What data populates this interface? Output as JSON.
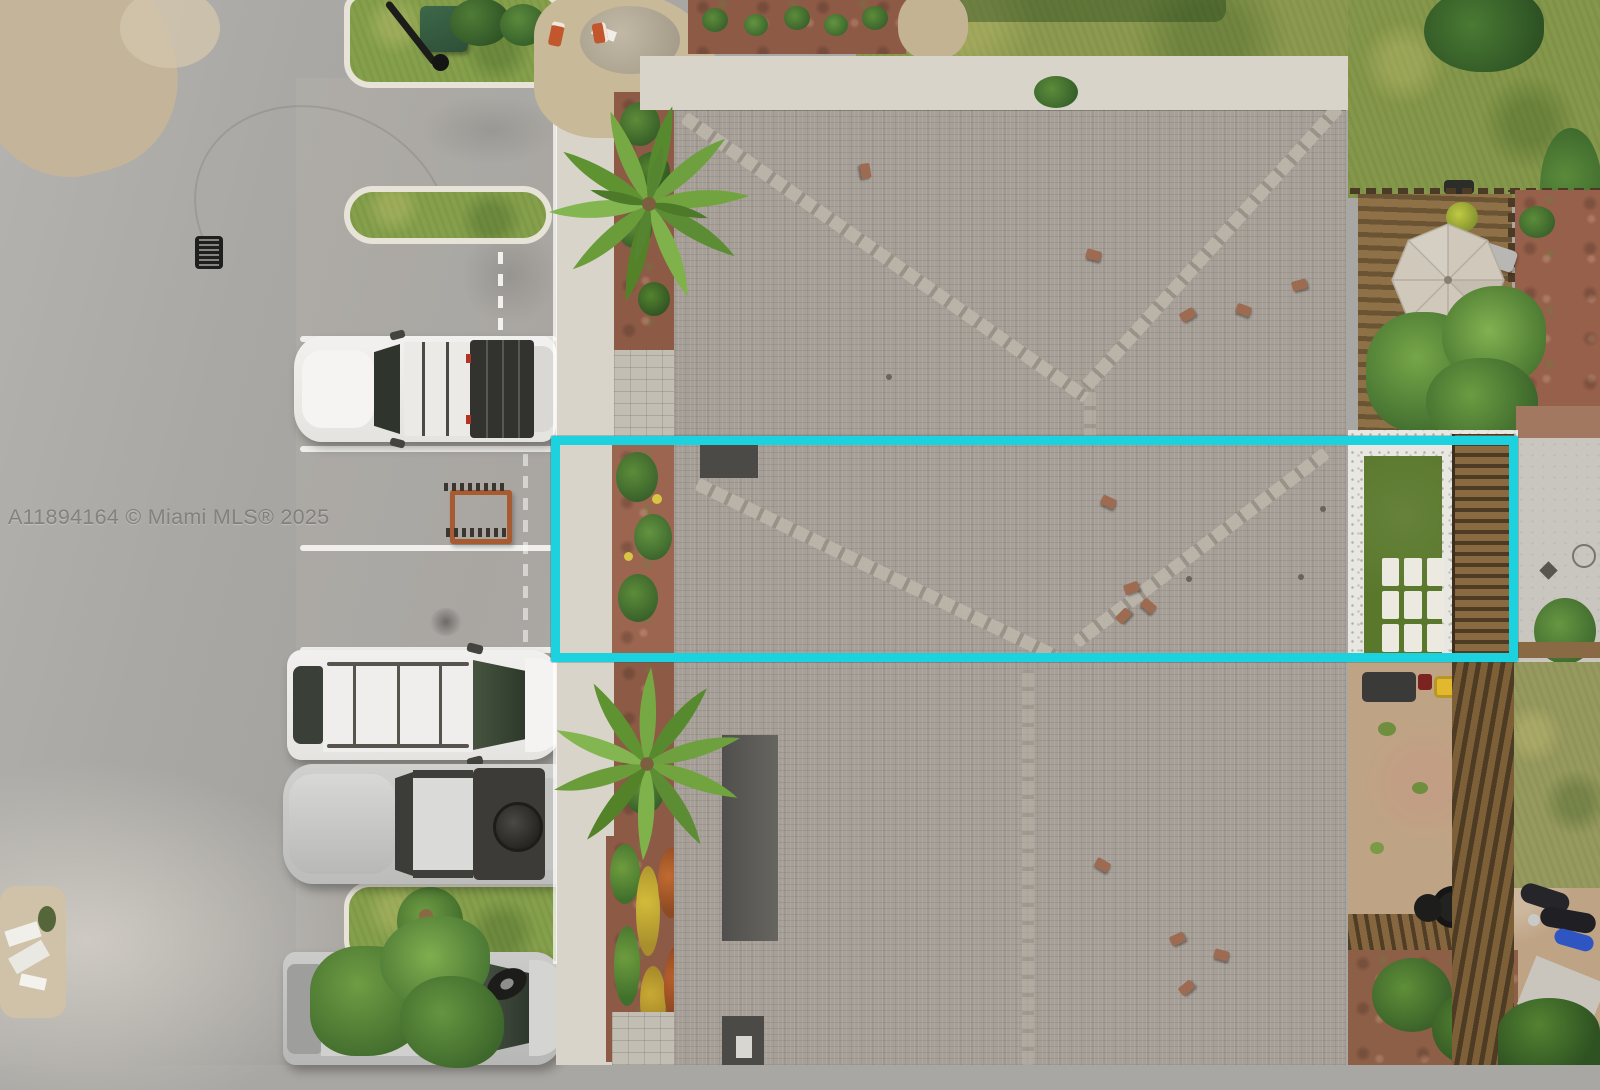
{
  "watermark": {
    "text": "A11894164 © Miami MLS® 2025"
  },
  "colors": {
    "highlight": "#1BD2DE",
    "asphalt": "#A9A7A3",
    "concrete": "#D9D4CA",
    "roof": "#A7A098",
    "roof_ridge": "#BCB5AA",
    "grass": "#85A04B",
    "turf": "#5A782C",
    "mulch": "#8D5A46",
    "gravel": "#E9E7E1",
    "wood_deck": "#8A6B42",
    "wood_fence": "#6E5636",
    "sand": "#C4B59A",
    "umbrella": "#D0C8BA",
    "vent": "#9C6B52",
    "cone": "#C2562C",
    "car_white": "#F1F0EE",
    "car_silver": "#C8C8C6",
    "car_dark": "#3B3B39"
  },
  "scene": {
    "type": "aerial-drone-photo",
    "description": "Top-down aerial view of a townhouse row; a cyan rectangle highlights one unit spanning from the front sidewalk across the shingle roof to its fenced backyard with artificial turf and paver grid. Left: asphalt street and parking stalls with four vehicles, grass medians, storm drain. Center: palm trees, flower beds, large hip shingle roof with vents. Right: backyards with wood deck, patio umbrella, trees, white gravel, wood fences, tires and motorcycles.",
    "highlight": {
      "shape": "rectangle",
      "purpose": "property-boundary-highlight"
    },
    "objects": [
      "asphalt street",
      "parking stalls",
      "white jeep",
      "white suv",
      "silver jeep with soft top",
      "silver suv under tree",
      "grass medians",
      "storm drain",
      "sidewalk",
      "palm trees",
      "flower beds",
      "shingle roof",
      "roof vents",
      "backyard turf with paver grid",
      "wood deck",
      "patio umbrella",
      "wood fence",
      "tires",
      "motorcycles",
      "construction cones"
    ]
  }
}
